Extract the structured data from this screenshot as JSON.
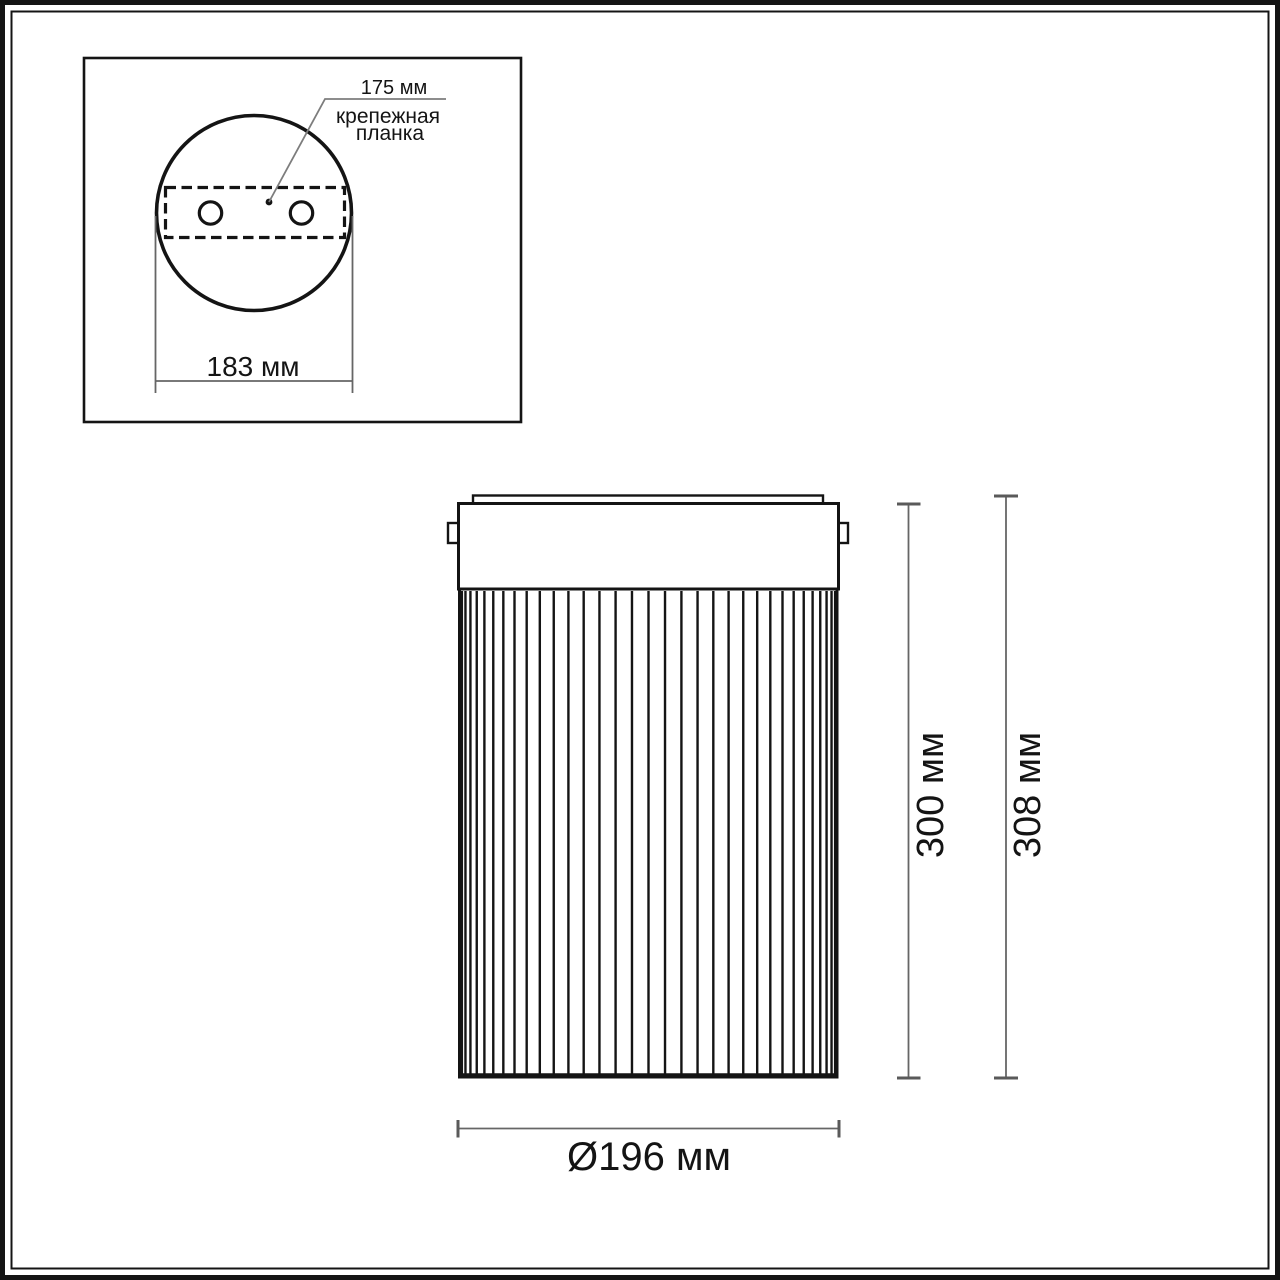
{
  "top_view": {
    "hole_spacing_label": "175 мм",
    "mount_plate_label_line1": "крепежная",
    "mount_plate_label_line2": "планка",
    "base_width_label": "183 мм"
  },
  "front_view": {
    "body_height_label": "300 мм",
    "overall_height_label": "308 мм",
    "diameter_label": "Ø196 мм"
  },
  "colors": {
    "outline": "#141414",
    "dim_line": "#666666",
    "dim_tick": "#5a5a5a",
    "text": "#141414",
    "background": "#ffffff"
  }
}
